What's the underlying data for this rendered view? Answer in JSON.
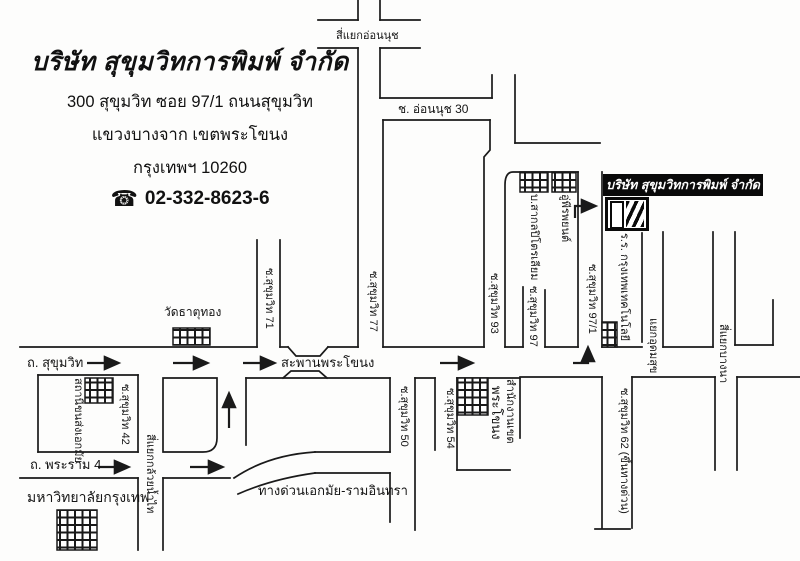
{
  "header": {
    "company_name": "บริษัท สุขุมวิทการพิมพ์ จำกัด",
    "address_line1": "300 สุขุมวิท ซอย 97/1 ถนนสุขุมวิท",
    "address_line2": "แขวงบางจาก เขตพระโขนง",
    "address_line3": "กรุงเทพฯ 10260",
    "phone_icon": "telephone-icon",
    "phone": "02-332-8623-6"
  },
  "colors": {
    "ink": "#1a1a1a",
    "paper": "#fdfdfc",
    "company_box_bg": "#0a0a0a",
    "company_box_text": "#ffffff"
  },
  "map": {
    "company_box_label": "บริษัท สุขุมวิทการพิมพ์ จำกัด",
    "logo": "striped-print-logo",
    "labels": [
      {
        "id": "onnut-junction",
        "text": "สี่แยกอ่อนนุช",
        "x": 336,
        "y": 30,
        "size": 11,
        "rot": false
      },
      {
        "id": "soi-onnut-30",
        "text": "ช. อ่อนนุช 30",
        "x": 398,
        "y": 103,
        "size": 12,
        "rot": false
      },
      {
        "id": "wat-thatthong",
        "text": "วัดธาตุทอง",
        "x": 164,
        "y": 306,
        "size": 12,
        "rot": false
      },
      {
        "id": "sukhumvit-road",
        "text": "ถ. สุขุมวิท",
        "x": 27,
        "y": 356,
        "size": 13,
        "rot": false
      },
      {
        "id": "phrakhanong-bridge",
        "text": "สะพานพระโขนง",
        "x": 281,
        "y": 356,
        "size": 13,
        "rot": false
      },
      {
        "id": "rama4-road",
        "text": "ถ. พระราม 4",
        "x": 30,
        "y": 458,
        "size": 13,
        "rot": false
      },
      {
        "id": "bangkok-university",
        "text": "มหาวิทยาลัยกรุงเทพ",
        "x": 27,
        "y": 489,
        "size": 14,
        "rot": false
      },
      {
        "id": "expressway-ekamai-raminthra",
        "text": "ทางด่วนเอกมัย-รามอินทรา",
        "x": 258,
        "y": 484,
        "size": 13,
        "rot": false
      },
      {
        "id": "soi-sukhumvit-71",
        "text": "ซ.สุขุมวิท 71",
        "x": 275,
        "y": 268,
        "size": 11,
        "rot": true
      },
      {
        "id": "soi-sukhumvit-77",
        "text": "ซ.สุขุมวิท 77",
        "x": 379,
        "y": 271,
        "size": 11,
        "rot": true
      },
      {
        "id": "soi-sukhumvit-93",
        "text": "ซ.สุขุมวิท 93",
        "x": 500,
        "y": 273,
        "size": 11,
        "rot": true
      },
      {
        "id": "soi-sukhumvit-97",
        "text": "ซ.สุขุมวิท 97",
        "x": 539,
        "y": 286,
        "size": 11,
        "rot": true
      },
      {
        "id": "soi-sukhumvit-97-1",
        "text": "ซ.สุขุมวิท 97/1",
        "x": 598,
        "y": 264,
        "size": 11,
        "rot": true
      },
      {
        "id": "sakol-petroleum",
        "text": "บ.สากลปิโตรเลียม",
        "x": 540,
        "y": 194,
        "size": 11,
        "rot": true
      },
      {
        "id": "peera-garage",
        "text": "อู่พีรพยนต์",
        "x": 571,
        "y": 194,
        "size": 11,
        "rot": true
      },
      {
        "id": "bangkok-technology-school",
        "text": "ร.ร. กรุงเทพเทคโนโลยี",
        "x": 630,
        "y": 233,
        "size": 11,
        "rot": true
      },
      {
        "id": "udomsuk-junction",
        "text": "แยกอุดมสุข",
        "x": 659,
        "y": 318,
        "size": 11,
        "rot": true
      },
      {
        "id": "bangna-junction",
        "text": "สี่แยกบางนา",
        "x": 729,
        "y": 324,
        "size": 11,
        "rot": true
      },
      {
        "id": "soi-sukhumvit-62",
        "text": "ซ.สุขุมวิท 62 (ขึ้นทางด่วน)",
        "x": 630,
        "y": 388,
        "size": 11,
        "rot": true
      },
      {
        "id": "ekamai-bus-terminal",
        "text": "สถานีขนส่งเอกมัย",
        "x": 84,
        "y": 378,
        "size": 11,
        "rot": true
      },
      {
        "id": "soi-sukhumvit-42",
        "text": "ซ.สุขุมวิท 42",
        "x": 131,
        "y": 384,
        "size": 11,
        "rot": true
      },
      {
        "id": "kluaynamthai-junction",
        "text": "สี่แยกกล้วยน้ำไท",
        "x": 156,
        "y": 434,
        "size": 11,
        "rot": true
      },
      {
        "id": "soi-sukhumvit-50",
        "text": "ซ.สุขุมวิท 50",
        "x": 410,
        "y": 386,
        "size": 11,
        "rot": true
      },
      {
        "id": "soi-sukhumvit-54",
        "text": "ซ.สุขุมวิท 54",
        "x": 456,
        "y": 388,
        "size": 11,
        "rot": true
      },
      {
        "id": "phrakhanong",
        "text": "พระโขนง",
        "x": 503,
        "y": 386,
        "size": 13,
        "rot": true
      },
      {
        "id": "district-office",
        "text": "สำนักงานเขต",
        "x": 516,
        "y": 379,
        "size": 11,
        "rot": true
      }
    ],
    "roads": [
      "M358,0 L358,20",
      "M380,0 L380,20",
      "M318,20 L358,20",
      "M380,20 L420,20",
      "M318,48 L358,48",
      "M380,48 L420,48",
      "M358,48 L358,347",
      "M380,48 L380,98",
      "M380,98 L492,98",
      "M492,75 L492,98",
      "M515,75 L515,143",
      "M515,143 L600,143",
      "M383,120 L383,347",
      "M383,120 L490,120",
      "M490,120 L490,150 L484,157 L484,347",
      "M505,347 L505,185 Q505,172 513,172 L578,172",
      "M523,287 L523,347",
      "M545,290 L545,347",
      "M578,172 L578,347",
      "M602,172 L602,347",
      "M642,233 L642,342",
      "M663,232 L663,347",
      "M663,347 L713,347",
      "M713,232 L713,347",
      "M735,232 L735,345",
      "M735,345 L773,345",
      "M773,300 L773,345",
      "M257,240 L257,347",
      "M280,240 L280,347",
      "M20,347 L257,347",
      "M280,347 L288,347",
      "M328,347 L358,347",
      "M383,347 L484,347",
      "M505,347 L523,347",
      "M545,347 L578,347",
      "M602,347 L642,347",
      "M288,347 L296,356 L320,356 L328,347",
      "M283,378 L291,371 L319,371 L327,378",
      "M38,375 L138,375",
      "M38,375 L38,452",
      "M38,452 L138,452",
      "M138,375 L138,452",
      "M163,378 L217,378 L217,438 Q217,452 203,452 L163,452 L163,378",
      "M138,478 L138,550",
      "M163,478 L163,550",
      "M20,478 L138,478",
      "M163,478 L230,478",
      "M246,378 L390,378",
      "M246,378 L246,445",
      "M390,378 L390,452",
      "M315,452 L390,452",
      "M315,473 L390,473",
      "M390,473 L390,522",
      "M315,452 Q268,455 234,478",
      "M315,473 Q272,479 238,494",
      "M415,378 L415,530",
      "M415,378 L435,378",
      "M435,378 L435,450",
      "M457,378 L520,378",
      "M457,378 L457,470",
      "M457,470 L510,470",
      "M520,379 L520,438",
      "M520,377 L602,377",
      "M602,377 L602,528",
      "M632,377 L632,528",
      "M595,529 L630,529",
      "M632,377 L715,377",
      "M737,377 L800,377",
      "M715,377 L715,470",
      "M737,377 L737,470"
    ],
    "route_arrows": [
      "M87,363 L118,363",
      "M173,363 L207,363",
      "M243,363 L274,363",
      "M440,363 L472,363",
      "M98,467 L128,467",
      "M190,467 L222,467",
      "M229,428 L229,394",
      "M573,363 L588,363 L588,348",
      "M575,218 L575,206 L595,206"
    ],
    "buildings": [
      {
        "id": "ekamai-terminal-block",
        "x": 85,
        "y": 378,
        "w": 28,
        "h": 25
      },
      {
        "id": "wat-thatthong-block",
        "x": 173,
        "y": 328,
        "w": 37,
        "h": 17
      },
      {
        "id": "sakol-petroleum-block",
        "x": 520,
        "y": 172,
        "w": 28,
        "h": 20
      },
      {
        "id": "garage-block",
        "x": 552,
        "y": 172,
        "w": 24,
        "h": 20
      },
      {
        "id": "soi-97-1-corner-block",
        "x": 602,
        "y": 322,
        "w": 15,
        "h": 25
      },
      {
        "id": "district-office-block",
        "x": 457,
        "y": 378,
        "w": 31,
        "h": 37
      },
      {
        "id": "bangkok-university-block",
        "x": 57,
        "y": 510,
        "w": 40,
        "h": 40
      }
    ]
  }
}
